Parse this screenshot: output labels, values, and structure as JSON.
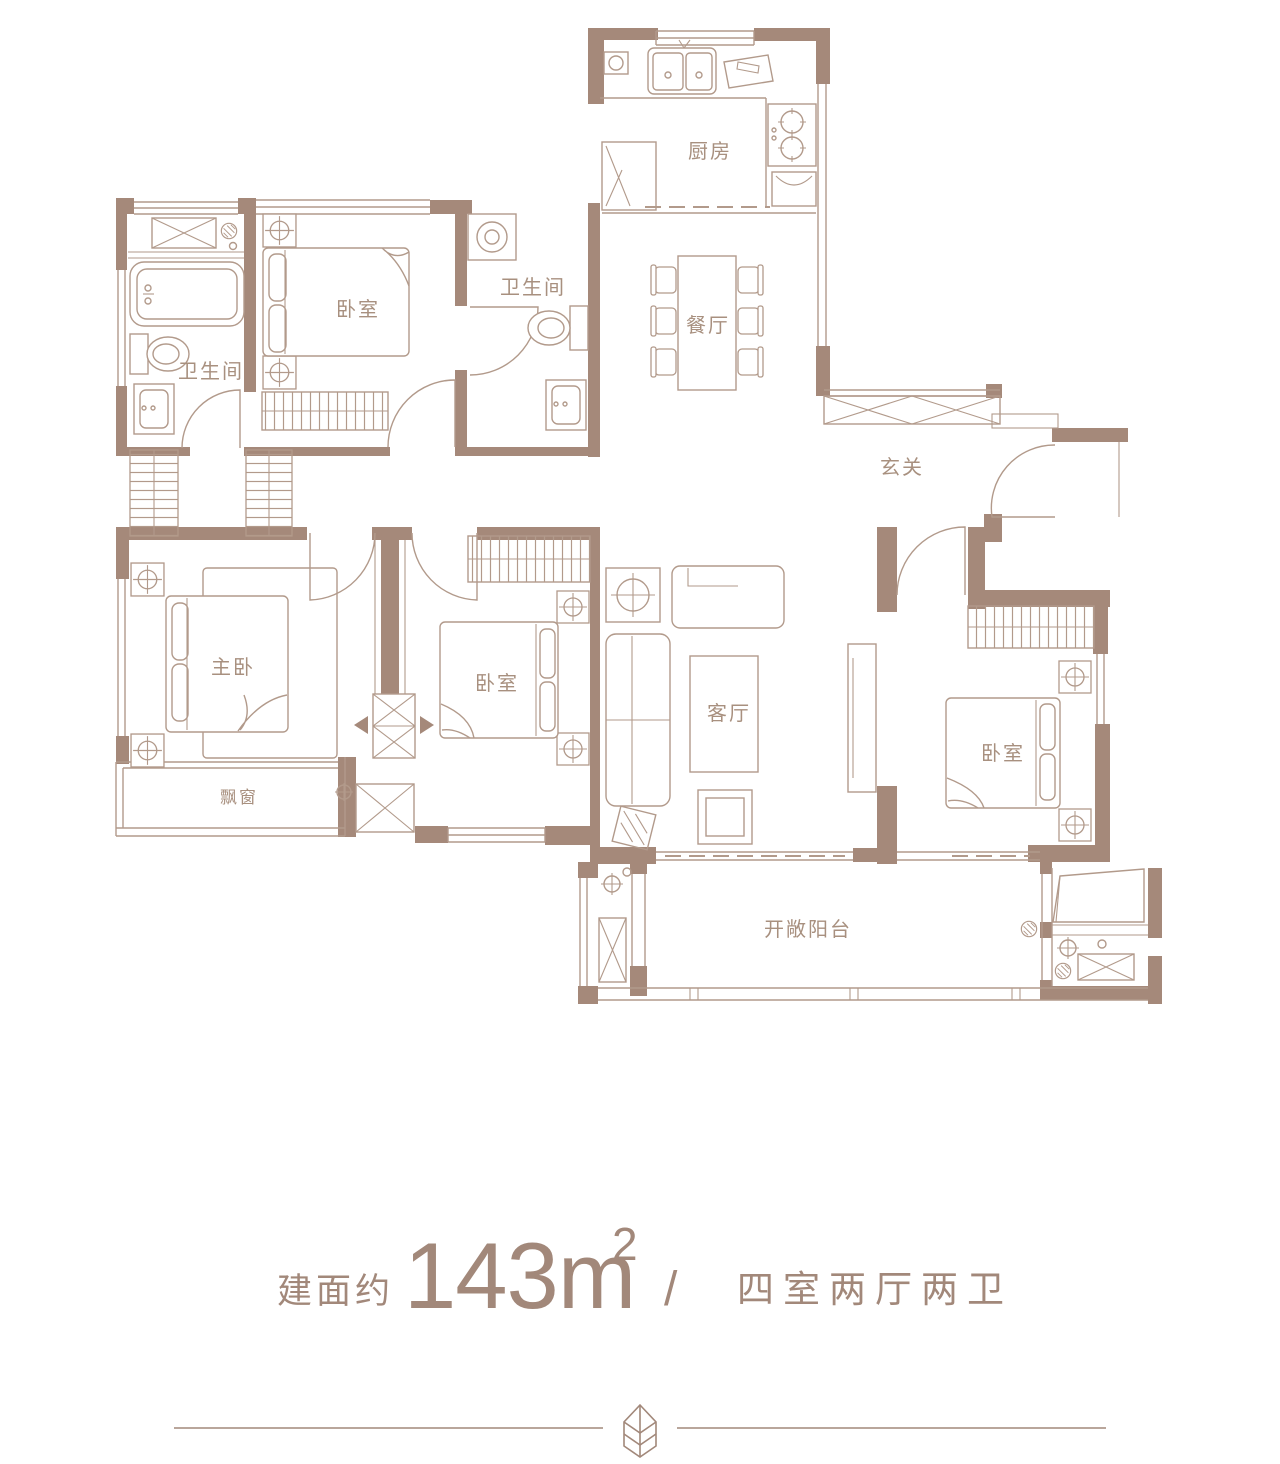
{
  "colors": {
    "wall": "#a5897a",
    "thin_line": "#b29a8b",
    "room_label": "#a8907f",
    "caption_text": "#a2887a",
    "background": "#ffffff"
  },
  "rooms": {
    "kitchen": "厨房",
    "bathroom_left": "卫生间",
    "bedroom_top": "卧室",
    "bathroom_top": "卫生间",
    "dining": "餐厅",
    "foyer": "玄关",
    "master_bedroom": "主卧",
    "bedroom_middle": "卧室",
    "living": "客厅",
    "bay_window": "飘窗",
    "bedroom_right": "卧室",
    "balcony": "开敞阳台"
  },
  "caption": {
    "area_prefix": "建面约",
    "area_value": "143m",
    "area_superscript": "2",
    "separator": "/",
    "layout_text": "四室两厅两卫"
  },
  "icons": {
    "footer_divider": "leaf-icon"
  }
}
